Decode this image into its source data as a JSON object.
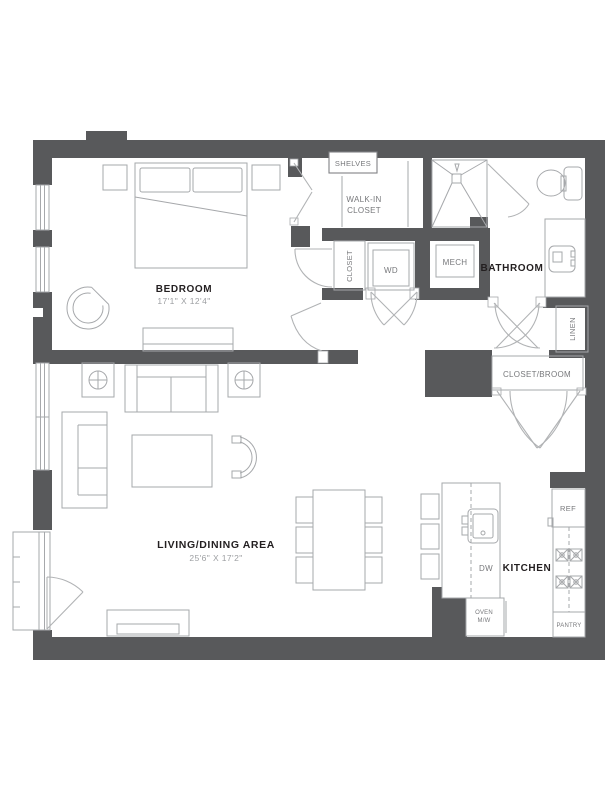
{
  "colors": {
    "background": "#ffffff",
    "wall": "#58595b",
    "furniture_line": "#a6a8ab",
    "door_line": "#b1b3b5",
    "box_border": "#808285",
    "room_label": "#231f20",
    "secondary_label": "#77787b",
    "dimension_label": "#9d9fa2"
  },
  "rooms": {
    "bedroom": {
      "label": "BEDROOM",
      "dimensions": "17'1\" X 12'4\""
    },
    "living_dining": {
      "label": "LIVING/DINING AREA",
      "dimensions": "25'6\" X 17'2\""
    },
    "bathroom": {
      "label": "BATHROOM"
    },
    "kitchen": {
      "label": "KITCHEN"
    },
    "walk_in_closet": {
      "label_line1": "WALK-IN",
      "label_line2": "CLOSET"
    },
    "closet": {
      "label": "CLOSET"
    },
    "linen": {
      "label": "LINEN"
    },
    "closet_broom": {
      "label": "CLOSET/BROOM"
    },
    "mech": {
      "label": "MECH"
    }
  },
  "fixtures": {
    "shelves": "SHELVES",
    "washer_dryer": "WD",
    "refrigerator": "REF",
    "dishwasher": "DW",
    "oven_microwave_line1": "OVEN",
    "oven_microwave_line2": "M/W",
    "pantry": "PANTRY"
  }
}
